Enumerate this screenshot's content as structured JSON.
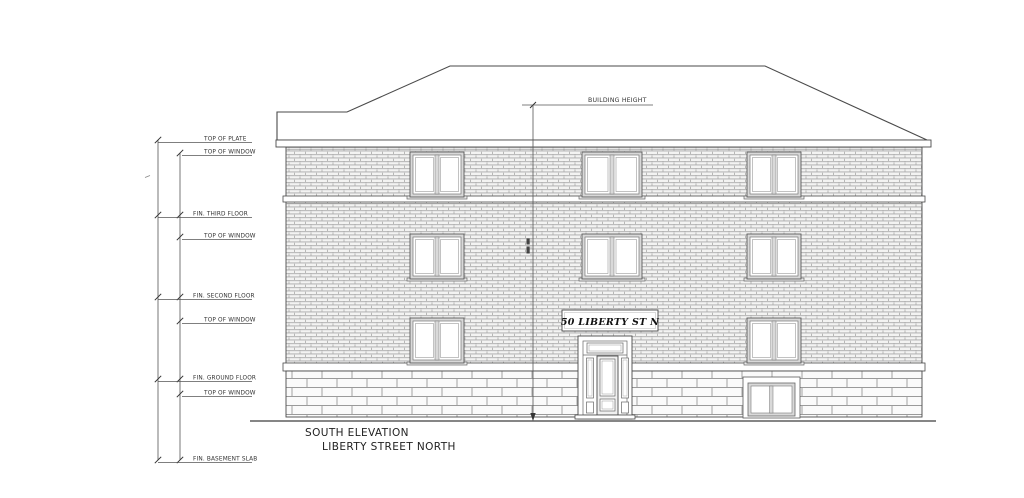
{
  "drawing": {
    "title": {
      "line1": "SOUTH ELEVATION",
      "line2": "LIBERTY STREET NORTH"
    },
    "sign_text": "50 LIBERTY ST N",
    "annotations": {
      "building_height": "BUILDING HEIGHT",
      "elevation_marks": [
        "TOP OF PLATE",
        "TOP OF WINDOW",
        "FIN. THIRD FLOOR",
        "TOP OF WINDOW",
        "FIN. SECOND FLOOR",
        "TOP OF WINDOW",
        "FIN. GROUND FLOOR",
        "TOP OF WINDOW",
        "FIN. BASEMENT SLAB"
      ]
    },
    "colors": {
      "line_ink": "#4a4a4a",
      "brick_fill": "#f3f3f2",
      "brick_joint": "#a9a9a9",
      "stone_fill": "#fafafa",
      "stone_joint": "#9a9a9a",
      "background": "#ffffff"
    }
  }
}
